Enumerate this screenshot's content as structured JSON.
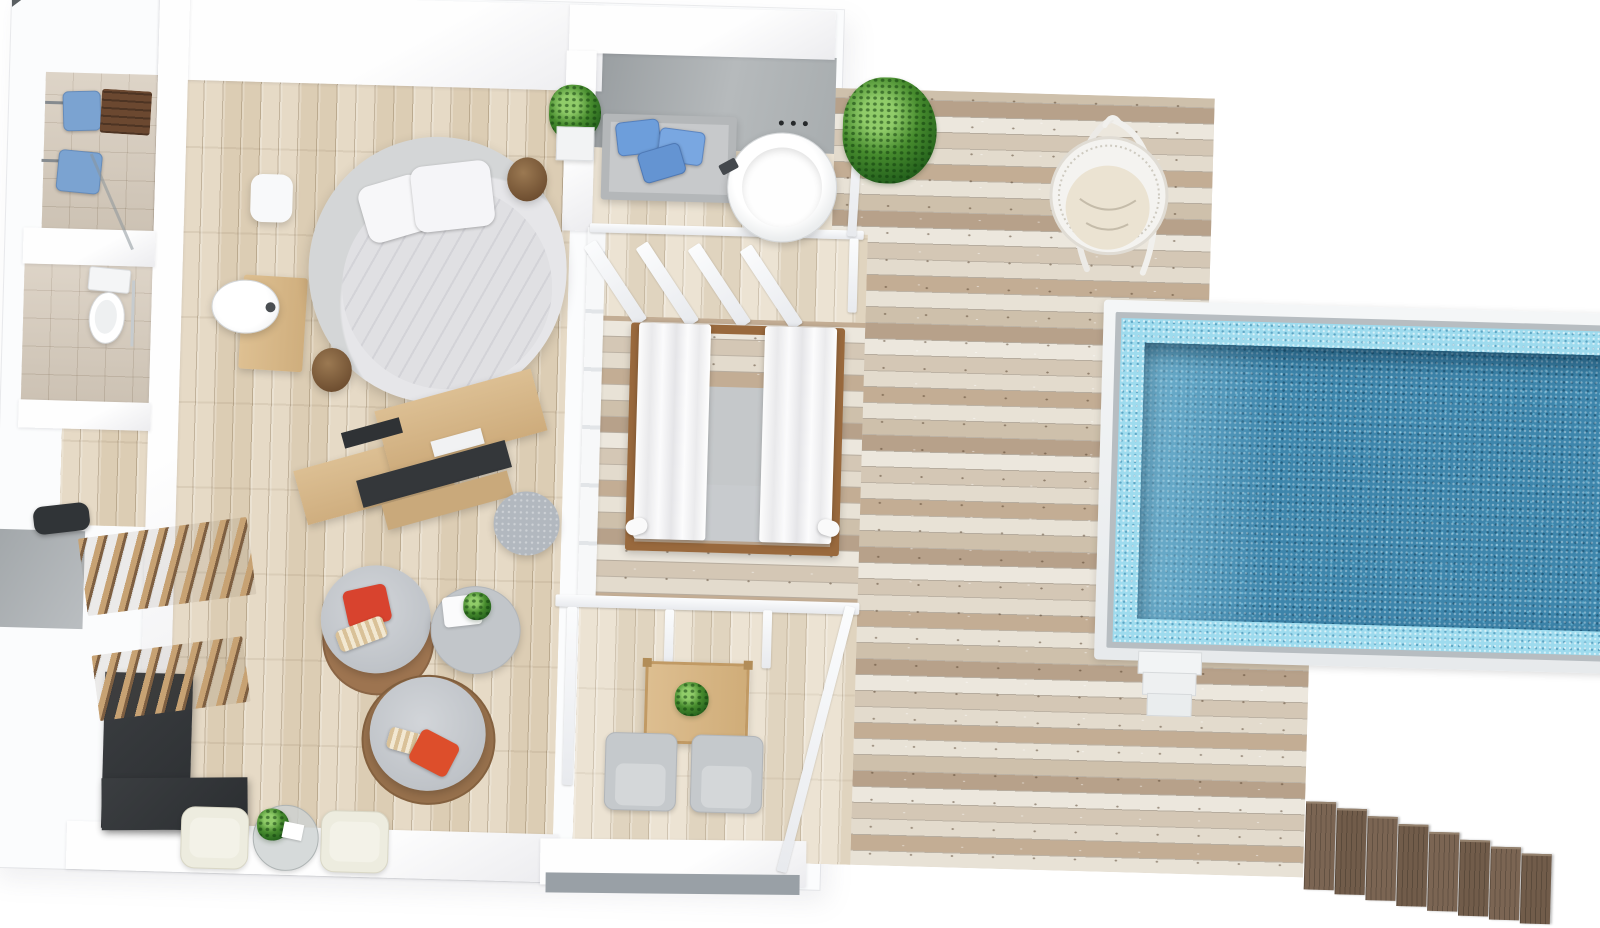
{
  "scene": {
    "kind": "3d-rendered-floor-plan",
    "subject": "Overwater pool villa suite viewed from above",
    "background": "#ffffff"
  },
  "palette": {
    "wall_white": "#fbfcfd",
    "interior_plank": "#e3d6c0",
    "terrace_plank": "#e9e0d0",
    "weathered_deck_light": "#ece7dd",
    "weathered_deck_dark": "#b7a18a",
    "tile_beige": "#d7ccbd",
    "concrete_gray": "#a3a8ab",
    "pool_water": "#3e86ac",
    "pool_tile_border": "#9edbee",
    "pool_rim": "#f4f6f7",
    "wood_oak": "#d2b286",
    "wood_stool": "#6f4f31",
    "wood_steps": "#7b6553",
    "dark_unit": "#34373a",
    "gray_cushion": "#c5c9cc",
    "blue_pillow": "#6d9edb",
    "red_pillow": "#d8432e",
    "orange_pillow": "#dd4e2b",
    "striped_pillow": "#d9c198",
    "plant_green": "#47842f",
    "curtain_white": "#fdfdfd",
    "bed_white": "#e0e0e3"
  },
  "areas": [
    {
      "name": "shower-room",
      "items": [
        "shower-tray",
        "shower-tray",
        "shower-head",
        "shower-head",
        "teak-bench",
        "glass-screen"
      ]
    },
    {
      "name": "wc",
      "items": [
        "toilet",
        "towel-rail"
      ]
    },
    {
      "name": "entry-corridor",
      "items": [
        "duffel-bag"
      ]
    },
    {
      "name": "landing",
      "items": []
    },
    {
      "name": "bedroom-living",
      "items": [
        "round-bed",
        "pillow",
        "pillow",
        "white-bench",
        "vanity-counter",
        "washbasin",
        "wall-plant",
        "side-stool",
        "side-stool",
        "media-console",
        "tv-panel",
        "pouf",
        "wood-coffee-table",
        "lounge-chair",
        "lounge-chair",
        "red-pillow",
        "orange-pillow",
        "striped-pillow",
        "striped-pillow",
        "round-side-table",
        "serving-tray",
        "plant",
        "slatted-screen",
        "slatted-screen",
        "dark-wardrobe-unit",
        "cream-chair",
        "cream-chair",
        "glass-table",
        "plant"
      ]
    },
    {
      "name": "outdoor-bathroom",
      "items": [
        "concrete-feature-wall",
        "shower-controls",
        "cushioned-bench",
        "blue-pillow",
        "blue-pillow",
        "blue-pillow",
        "round-bathtub",
        "bath-faucet",
        "railing"
      ]
    },
    {
      "name": "canopy-daybed-terrace",
      "items": [
        "canopy-daybed",
        "curtain",
        "curtain",
        "mattress",
        "pergola-rafters",
        "railing"
      ]
    },
    {
      "name": "dining-balcony",
      "items": [
        "pergola-beam",
        "pergola-posts",
        "dining-table",
        "plant",
        "armchair",
        "armchair",
        "parapet"
      ]
    },
    {
      "name": "sun-deck",
      "items": [
        "shrub-plant",
        "hanging-egg-chair"
      ]
    },
    {
      "name": "pool",
      "items": [
        "white-rim",
        "stone-coping",
        "mosaic-border",
        "mosaic-water",
        "entry-steps"
      ]
    },
    {
      "name": "shore-access",
      "items": [
        "wooden-stairs"
      ]
    }
  ]
}
